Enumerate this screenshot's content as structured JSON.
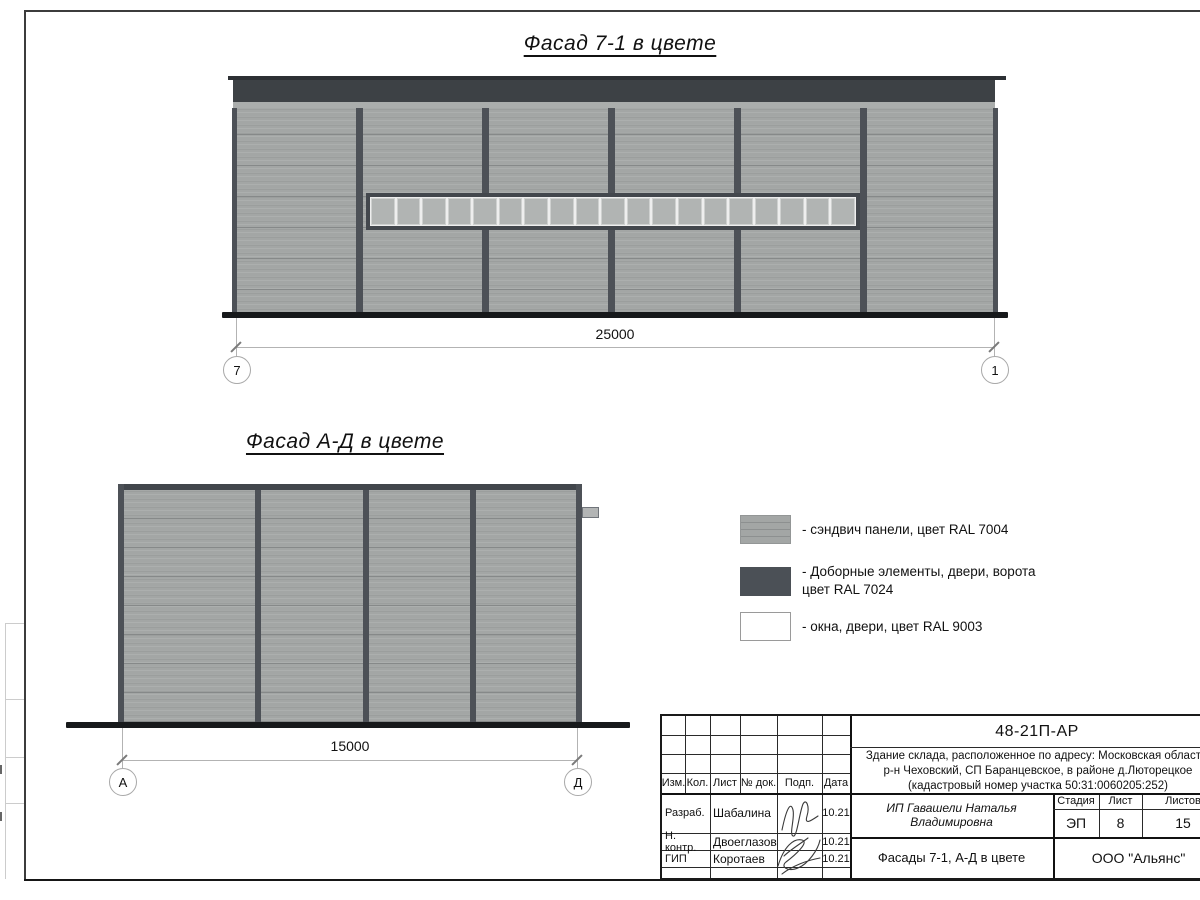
{
  "facade_7_1": {
    "title": "Фасад 7-1 в цвете",
    "dimension_label": "25000",
    "axis_left": "7",
    "axis_right": "1",
    "window_pane_count": 19
  },
  "facade_a_d": {
    "title": "Фасад А-Д в цвете",
    "dimension_label": "15000",
    "axis_left": "А",
    "axis_right": "Д"
  },
  "legend": {
    "items": [
      {
        "label": "- сэндвич панели, цвет RAL 7004",
        "color": "#a3a6a5"
      },
      {
        "label_line1": "- Доборные элементы, двери, ворота",
        "label_line2": "цвет RAL 7024",
        "color": "#4b5056"
      },
      {
        "label": "- окна, двери, цвет RAL 9003",
        "color": "#ffffff"
      }
    ]
  },
  "title_block": {
    "doc_number": "48-21П-АР",
    "project_line1": "Здание склада, расположенное по адресу: Московская область,",
    "project_line2": "р-н Чеховский, СП Баранцевское, в районе д.Люторецкое",
    "project_line3": "(кадастровый номер участка 50:31:0060205:252)",
    "columns": {
      "izm": "Изм.",
      "kol": "Кол.",
      "list": "Лист",
      "doc": "№ док.",
      "podp": "Подп.",
      "data": "Дата"
    },
    "stage_header": {
      "stage": "Стадия",
      "sheet": "Лист",
      "sheets": "Листов"
    },
    "stage_values": {
      "stage": "ЭП",
      "sheet": "8",
      "sheets": "15"
    },
    "client": "ИП Гавашели Наталья Владимировна",
    "sheet_title": "Фасады 7-1, А-Д в цвете",
    "company": "ООО \"Альянс\"",
    "roles": [
      {
        "role": "Разраб.",
        "name": "Шабалина",
        "date": "10.21"
      },
      {
        "role": "Н. контр.",
        "name": "Двоеглазов",
        "date": "10.21"
      },
      {
        "role": "ГИП",
        "name": "Коротаев",
        "date": "10.21"
      }
    ]
  }
}
